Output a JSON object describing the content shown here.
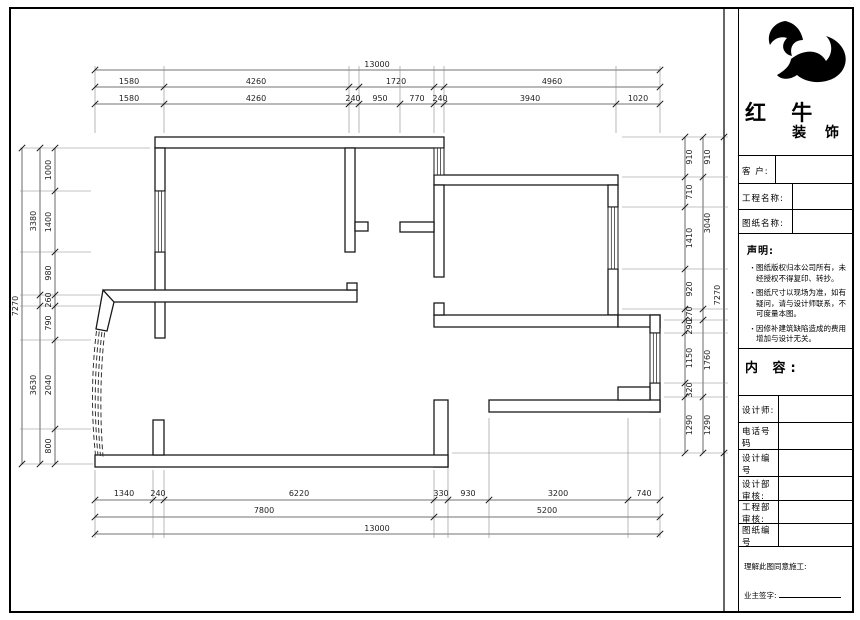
{
  "title_block": {
    "brand_line1": "红 牛",
    "brand_line2": "装 饰",
    "logo_icon": "bull-swoosh",
    "fields": [
      {
        "label": "客  户:",
        "value": ""
      },
      {
        "label": "工程名称:",
        "value": ""
      },
      {
        "label": "图纸名称:",
        "value": ""
      }
    ],
    "statement": {
      "heading": "声明:",
      "items": [
        "图纸版权归本公司所有，未经授权不得复印、转抄。",
        "图纸尺寸以现场为准，如有疑问，请与设计师联系，不可度量本图。",
        "因修补建筑缺陷造成的费用增加与设计无关。"
      ]
    },
    "content_label": "内 容:",
    "info_rows": [
      {
        "label": "设计师:",
        "value": ""
      },
      {
        "label": "电话号码",
        "value": ""
      },
      {
        "label": "设计编号",
        "value": ""
      },
      {
        "label": "设计部审核:",
        "value": ""
      },
      {
        "label": "工程部审核:",
        "value": ""
      },
      {
        "label": "图纸编号",
        "value": ""
      }
    ],
    "footer": {
      "line1": "理解此图同意施工:",
      "line2": "业主签字:"
    }
  },
  "dimensions": {
    "top_row1": [
      "13000"
    ],
    "top_row2": [
      "1580",
      "4260",
      "1720",
      "4960"
    ],
    "top_row3": [
      "1580",
      "4260",
      "240",
      "950",
      "770",
      "240",
      "3940",
      "1020"
    ],
    "bottom_row1": [
      "1340",
      "240",
      "6220",
      "330",
      "930",
      "3200",
      "740"
    ],
    "bottom_row2": [
      "7800",
      "5200"
    ],
    "bottom_row3": [
      "13000"
    ],
    "left_inner": [
      "1000",
      "1400",
      "980",
      "260",
      "790",
      "2040",
      "800"
    ],
    "left_mid": [
      "3380",
      "3630"
    ],
    "left_outer": [
      "7270"
    ],
    "right_inner": [
      "910",
      "710",
      "1410",
      "920",
      "270",
      "290",
      "1150",
      "320",
      "1290"
    ],
    "right_mid": [
      "910",
      "3040",
      "1760",
      "1290"
    ],
    "right_outer": [
      "7270"
    ]
  }
}
